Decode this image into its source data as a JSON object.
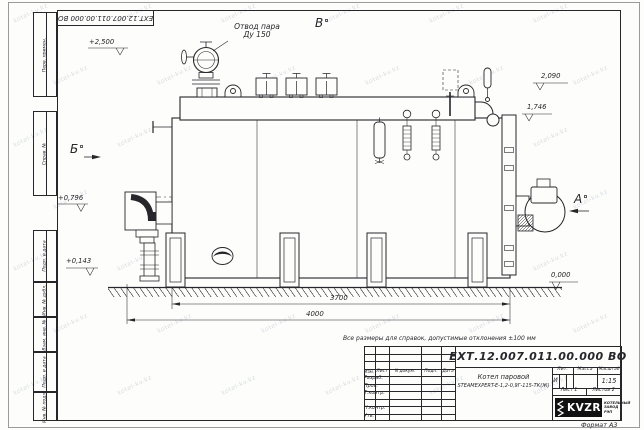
{
  "sheet": {
    "format_label": "Формат А3",
    "note": "Все размеры для справок, допустимые отклонения ±100 мм",
    "watermark": "kotel-kv.kz",
    "corner_doc_number": "ЕХТ.12.007.011.00.000  ВО"
  },
  "side_stamps": {
    "labels": [
      "Перв. примен.",
      "Справ. №",
      "Подп. и дата",
      "Инв. № дубл.",
      "Взам. инв. №",
      "Подп. и дата",
      "Инв. № подл."
    ]
  },
  "drawing": {
    "callout": {
      "line1": "Отвод пара",
      "line2": "Ду 150"
    },
    "views": {
      "top": "В",
      "left": "Б",
      "right": "А"
    },
    "elevations": {
      "e2500": "+2,500",
      "e2090": "2,090",
      "e1746": "1,746",
      "e0796": "+0,796",
      "e0143": "+0,143",
      "e0000": "0,000"
    },
    "dimensions": {
      "shell_length": "3700",
      "overall_length": "4000"
    }
  },
  "title_block": {
    "doc_number": "ЕХТ.12.007.011.00.000  ВО",
    "product_name": {
      "line1": "Котел паровой",
      "line2": "STEAMEXPERT-Е-1,2-0,9Г-115-ТК(Ж)"
    },
    "col_headers": {
      "izm": "Изм.",
      "list": "Лист",
      "doc": "N докум.",
      "sign": "Подп.",
      "date": "Дата"
    },
    "row_labels": {
      "developed": "Разраб.",
      "checked": "Пров.",
      "t_control": "Т.контр.",
      "n_control": "Н.контр.",
      "approved": "Утв."
    },
    "right_headers": {
      "litera": "Лит.",
      "mass": "Масса",
      "scale": "Масштаб"
    },
    "litera_value": "И",
    "scale_value": "1:15",
    "sheet_info": {
      "sheet": "Лист 1",
      "sheets": "Листов 2"
    },
    "logo": {
      "text": "KVZR",
      "caption_line1": "КОТЕЛЬНЫЙ",
      "caption_line2": "ЗАВОД РЭП"
    }
  }
}
